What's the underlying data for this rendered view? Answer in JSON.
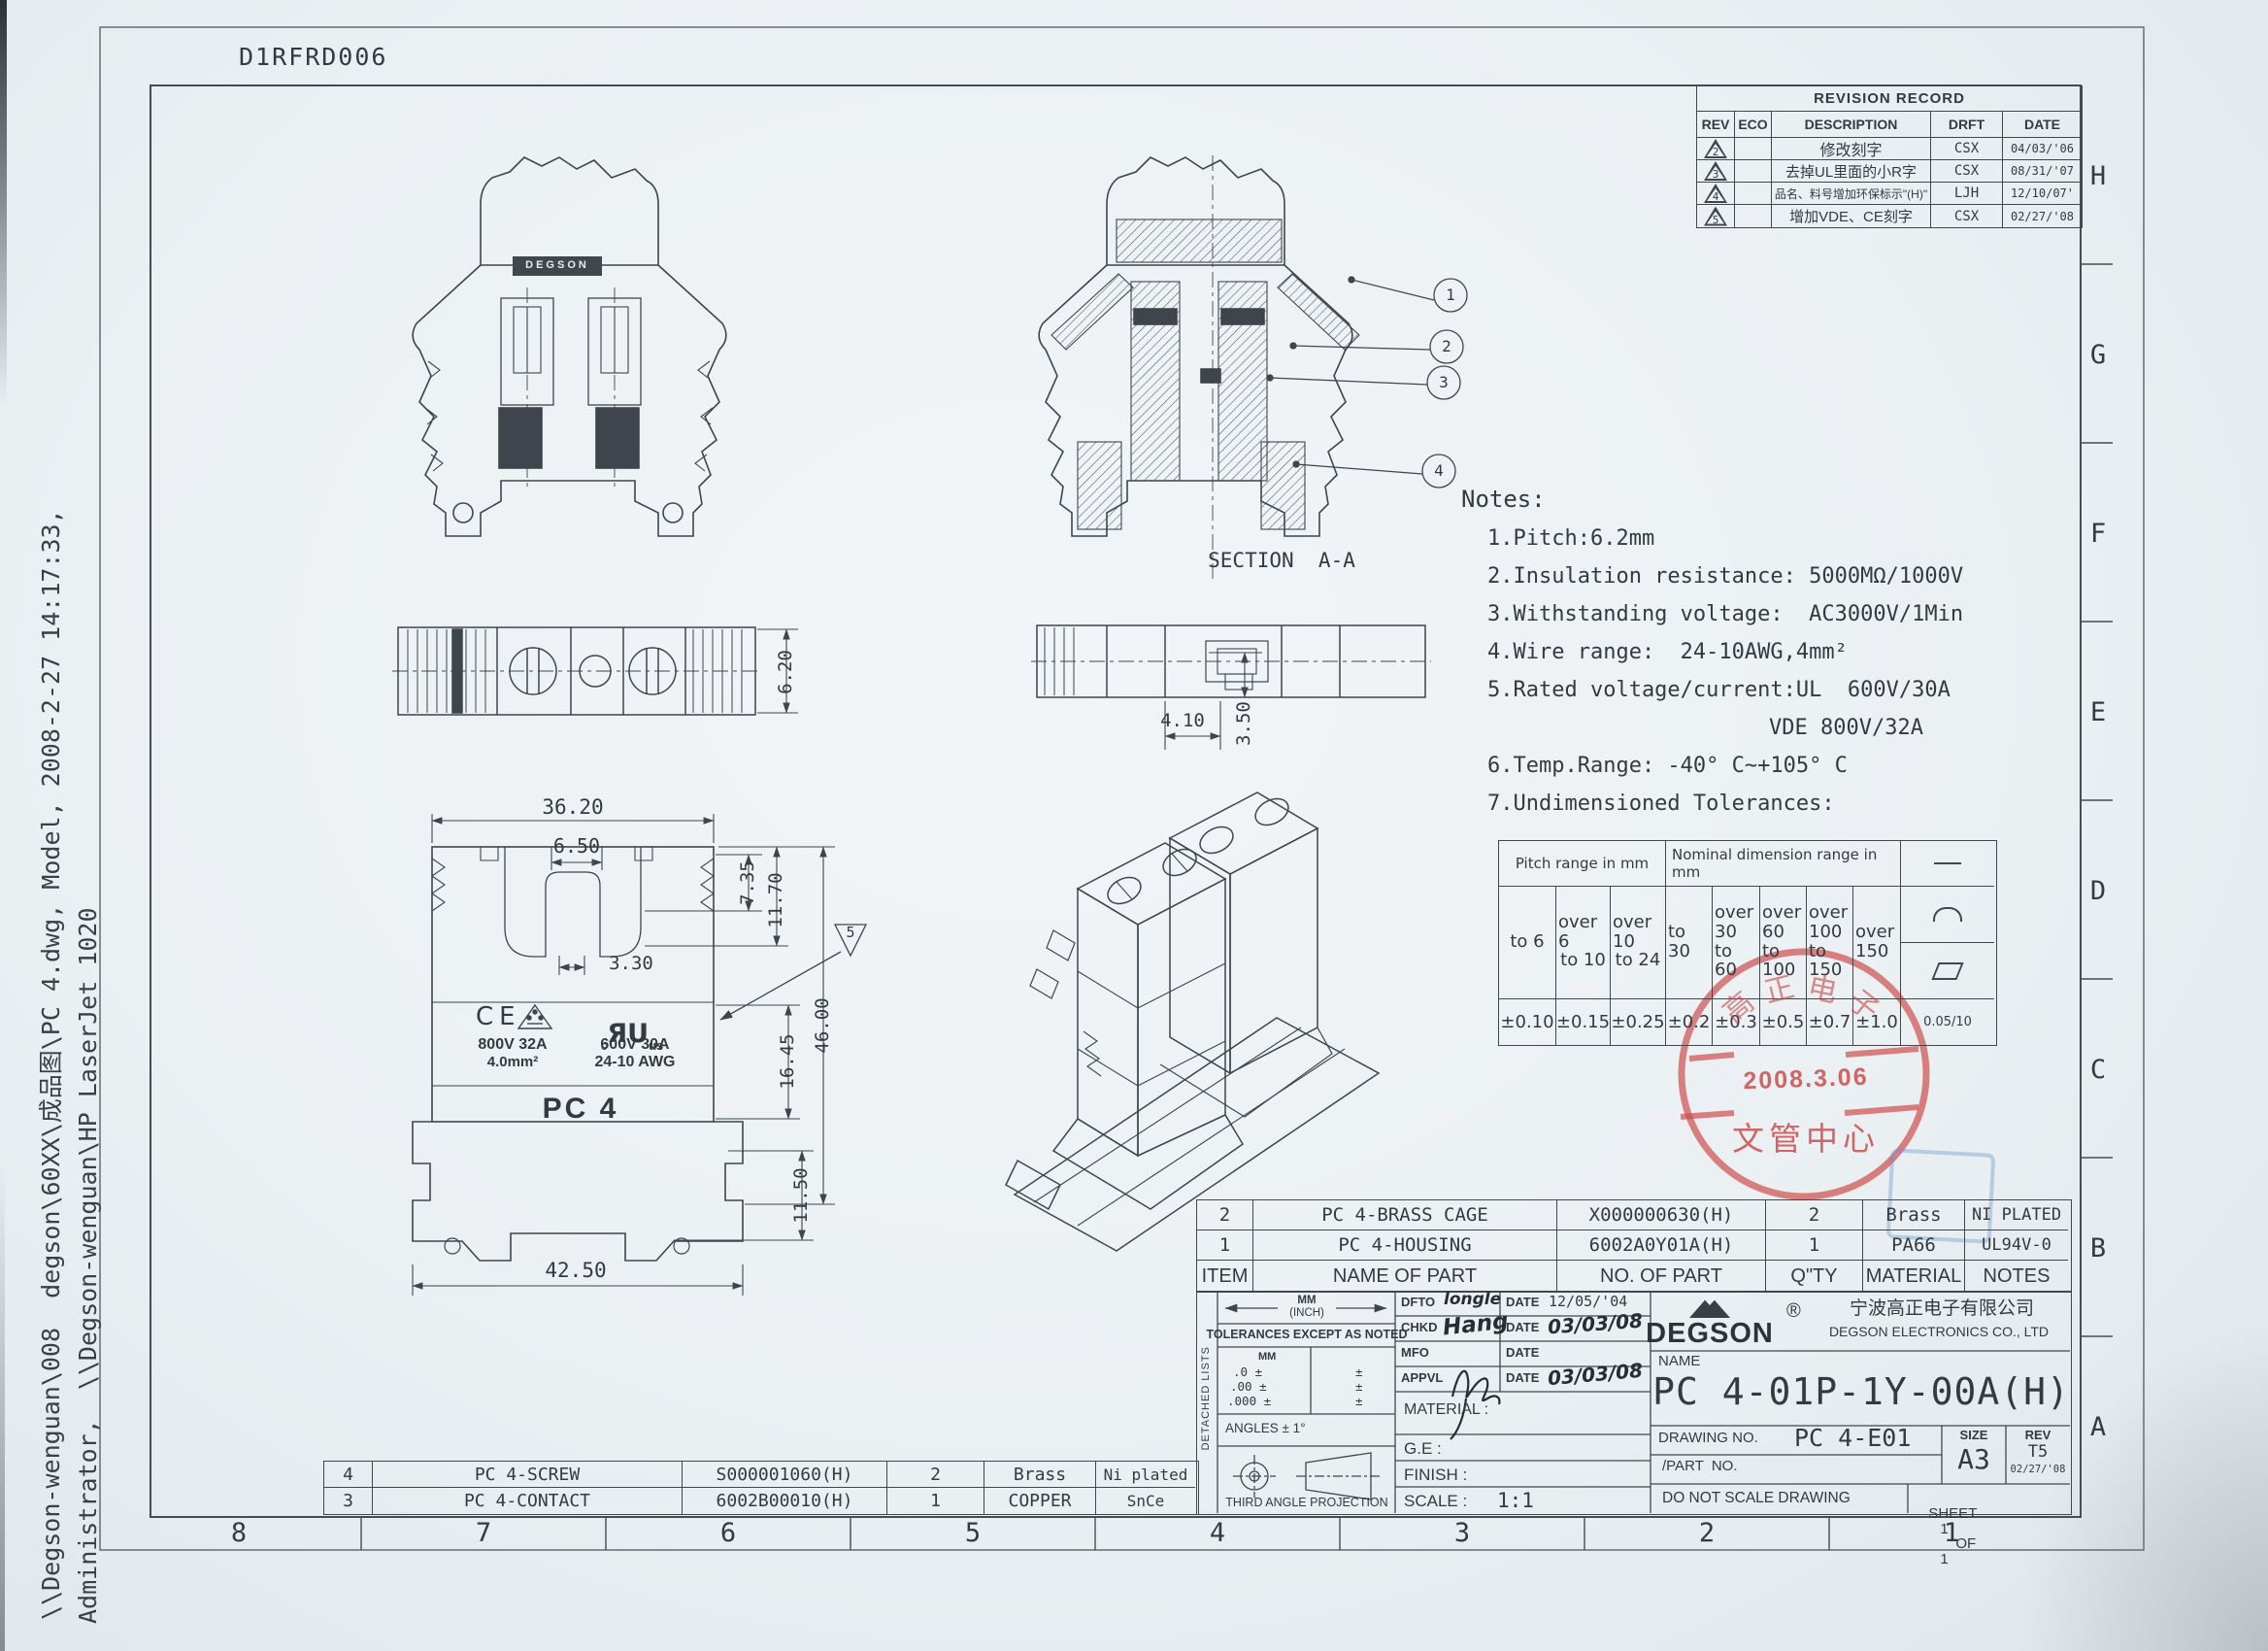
{
  "doc_id": "D1RFRD006",
  "side_text": {
    "line1": "\\\\Degson-wenguan\\008  degson\\60XX\\成品图\\PC 4.dwg, Model, 2008-2-27 14:17:33,",
    "line2": "Administrator,  \\\\Degson-wenguan\\HP LaserJet 1020"
  },
  "zones": {
    "right": [
      "H",
      "G",
      "F",
      "E",
      "D",
      "C",
      "B",
      "A"
    ],
    "bottom": [
      "8",
      "7",
      "6",
      "5",
      "4",
      "3",
      "2",
      "1"
    ]
  },
  "revision_record": {
    "title": "REVISION RECORD",
    "headers": {
      "rev": "REV",
      "eco": "ECO",
      "description": "DESCRIPTION",
      "drft": "DRFT",
      "date": "DATE"
    },
    "rows": [
      {
        "rev": "2",
        "eco": "",
        "description": "修改刻字",
        "drft": "CSX",
        "date": "04/03/'06"
      },
      {
        "rev": "3",
        "eco": "",
        "description": "去掉UL里面的小R字",
        "drft": "CSX",
        "date": "08/31/'07"
      },
      {
        "rev": "4",
        "eco": "",
        "description": "品名、料号增加环保标示\"(H)\"",
        "drft": "LJH",
        "date": "12/10/07'"
      },
      {
        "rev": "5",
        "eco": "",
        "description": "增加VDE、CE刻字",
        "drft": "CSX",
        "date": "02/27/'08"
      }
    ]
  },
  "views": {
    "section_label": "SECTION  A-A",
    "callouts": [
      "1",
      "2",
      "3",
      "4"
    ],
    "triangle_callout": "5"
  },
  "dims": {
    "front": [
      "36.20",
      "6.50",
      "7.35",
      "11.70",
      "3.30",
      "16.45",
      "46.00",
      "11.50",
      "42.50"
    ],
    "top_left_height": "6.20",
    "top_mid_width": "4.10",
    "top_mid_height": "3.50"
  },
  "markings": {
    "ce": "CE",
    "vde_line1": "800V 32A",
    "vde_line2": "4.0mm²",
    "ul_c": "c",
    "ul_mark": "ЯU",
    "ul_us": "us",
    "ul_line1": "600V 30A",
    "ul_line2": "24-10 AWG",
    "product": "PC 4",
    "emboss": "DEGSON"
  },
  "notes": {
    "title": "Notes:",
    "lines": [
      "1.Pitch:6.2mm",
      "2.Insulation resistance: 5000MΩ/1000V",
      "3.Withstanding voltage:  AC3000V/1Min",
      "4.Wire range:  24-10AWG,4mm²",
      "5.Rated voltage/current:UL  600V/30A",
      "VDE 800V/32A",
      "6.Temp.Range: -40° C~+105° C",
      "7.Undimensioned Tolerances:"
    ]
  },
  "tolerance_table": {
    "pitch_header": "Pitch range in mm",
    "nominal_header": "Nominal dimension range in mm",
    "symbol_names": [
      "straightness",
      "arc",
      "flatness"
    ],
    "ranges": [
      {
        "over": "",
        "to": "to 6"
      },
      {
        "over": "over 6",
        "to": "to 10"
      },
      {
        "over": "over 10",
        "to": "to 24"
      },
      {
        "over": "",
        "to": "to 30"
      },
      {
        "over": "over 30",
        "to": "to 60"
      },
      {
        "over": "over 60",
        "to": "to 100"
      },
      {
        "over": "over 100",
        "to": "to 150"
      },
      {
        "over": "over 150",
        "to": ""
      }
    ],
    "values": [
      "±0.10",
      "±0.15",
      "±0.25",
      "±0.2",
      "±0.3",
      "±0.5",
      "±0.7",
      "±1.0"
    ],
    "flatness_value": "0.05/10"
  },
  "stamp": {
    "arc_text": [
      "高",
      "正",
      "电",
      "子"
    ],
    "date": "2008.3.06",
    "center_text": "文管中心"
  },
  "parts_upper": {
    "headers": {
      "item": "ITEM",
      "name": "NAME OF PART",
      "no": "NO. OF PART",
      "qty": "Q\"TY",
      "material": "MATERIAL",
      "notes": "NOTES"
    },
    "rows": [
      {
        "item": "2",
        "name": "PC 4-BRASS CAGE",
        "no": "X000000630(H)",
        "qty": "2",
        "material": "Brass",
        "notes": "NI PLATED"
      },
      {
        "item": "1",
        "name": "PC 4-HOUSING",
        "no": "6002A0Y01A(H)",
        "qty": "1",
        "material": "PA66",
        "notes": "UL94V-0"
      }
    ]
  },
  "parts_lower": {
    "rows": [
      {
        "item": "4",
        "name": "PC 4-SCREW",
        "no": "S000001060(H)",
        "qty": "2",
        "material": "Brass",
        "notes": "Ni plated"
      },
      {
        "item": "3",
        "name": "PC 4-CONTACT",
        "no": "6002B00010(H)",
        "qty": "1",
        "material": "COPPER",
        "notes": "SnCe"
      }
    ]
  },
  "title_block": {
    "detached_lists": "DETACHED LISTS",
    "mm": "MM",
    "inch": "(INCH)",
    "tolerances_note": "TOLERANCES EXCEPT AS NOTED",
    "mm_small": "MM",
    "tol_rows": [
      ".0 ±",
      ".00 ±",
      ".000 ±"
    ],
    "tol_pm": "±",
    "angles": "ANGLES ± 1°",
    "projection": "THIRD ANGLE PROJECTION",
    "dfto_label": "DFTO",
    "dfto_value": "longle",
    "chkd_label": "CHKD",
    "chkd_value": "Hang",
    "mfo_label": "MFO",
    "appvl_label": "APPVL",
    "date_label": "DATE",
    "dfto_date": "12/05/'04",
    "chkd_date": "03/03/08",
    "appvl_date": "03/03/08",
    "material_label": "MATERIAL :",
    "ge_label": "G.E :",
    "finish_label": "FINISH :",
    "scale_label": "SCALE :",
    "scale_value": "1:1",
    "brand": "DEGSON",
    "registered": "®",
    "company_cn": "宁波高正电子有限公司",
    "company_en": "DEGSON ELECTRONICS CO., LTD",
    "name_label": "NAME",
    "product_name": "PC 4-01P-1Y-00A(H)",
    "drawing_no_label": "DRAWING NO.",
    "drawing_no": "PC 4-E01",
    "part_no_label": "/PART  NO.",
    "size_label": "SIZE",
    "size_value": "A3",
    "rev_label": "REV",
    "rev_value": "T5",
    "rev_date": "02/27/'08",
    "no_scale": "DO NOT SCALE DRAWING",
    "sheet_label": "SHEET",
    "sheet_no": "1",
    "of_label": "OF",
    "of_no": "1"
  }
}
